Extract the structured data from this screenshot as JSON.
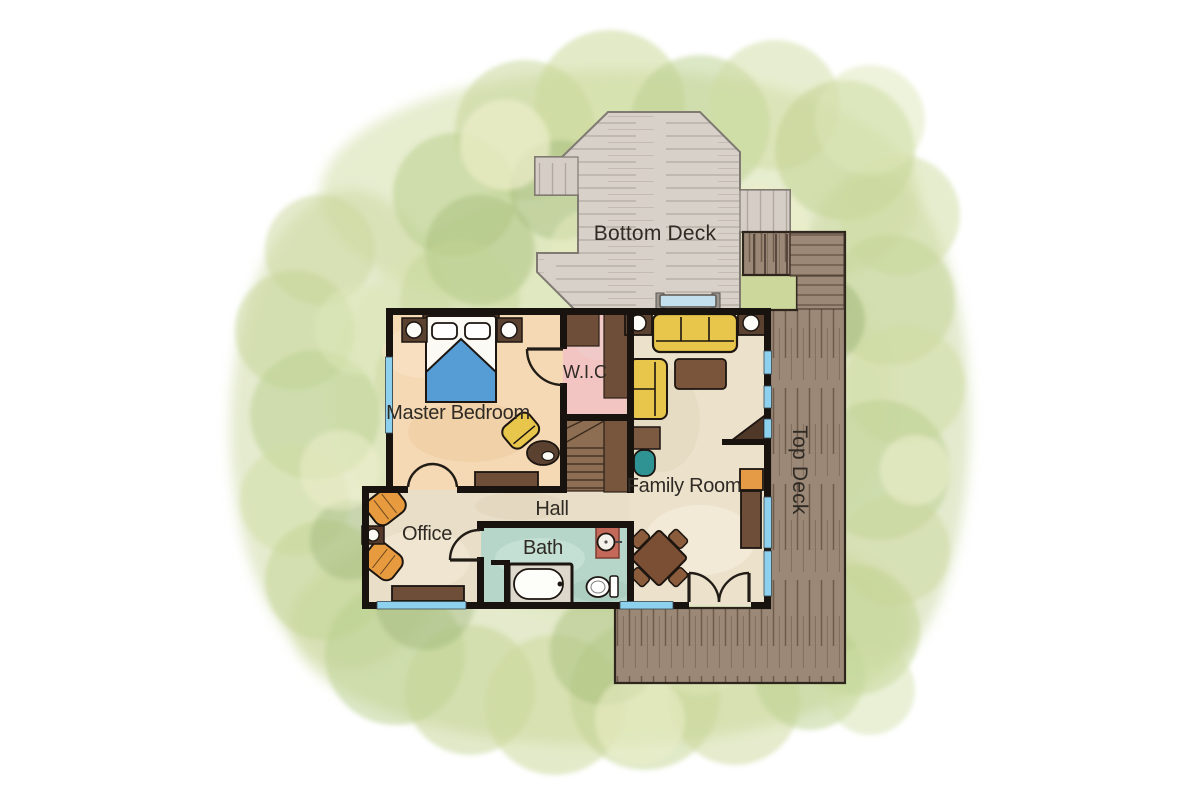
{
  "title": "House floor plan",
  "labels": {
    "bottom_deck": "Bottom Deck",
    "top_deck": "Top Deck",
    "master_bedroom": "Master Bedroom",
    "walk_in_closet": "W.I.C",
    "hall": "Hall",
    "office": "Office",
    "bath": "Bath",
    "family_room": "Family Room"
  },
  "rooms": [
    {
      "name": "Bottom Deck"
    },
    {
      "name": "Top Deck"
    },
    {
      "name": "Master Bedroom"
    },
    {
      "name": "W.I.C"
    },
    {
      "name": "Hall"
    },
    {
      "name": "Office"
    },
    {
      "name": "Bath"
    },
    {
      "name": "Family Room"
    }
  ],
  "colors": {
    "background": "#ffffff",
    "foliage_green": "#c3d493",
    "foliage_green_dark": "#9cb573",
    "foliage_yellow": "#eceec9",
    "bottom_deck": "#d8d1ca",
    "top_deck": "#9a8776",
    "wall": "#191310",
    "master_floor": "#f4d9b4",
    "family_floor": "#ece2cc",
    "office_floor": "#e9dfc9",
    "wic_floor": "#f2c5c2",
    "bath_floor": "#b7d6ca",
    "window_blue": "#8ed1ee",
    "sofa_yellow": "#e7c64b",
    "chair_orange": "#e89a3e",
    "bed_blue": "#569dd6",
    "wood_brown": "#6e4e38",
    "wood_dark": "#5b4130",
    "teal_chair": "#2f9394",
    "sink_terracotta": "#c4695a",
    "lawn_cutout": "#ccd79c",
    "deck_label_gray": "#9b968f",
    "room_label_dark": "#2f2a24"
  }
}
